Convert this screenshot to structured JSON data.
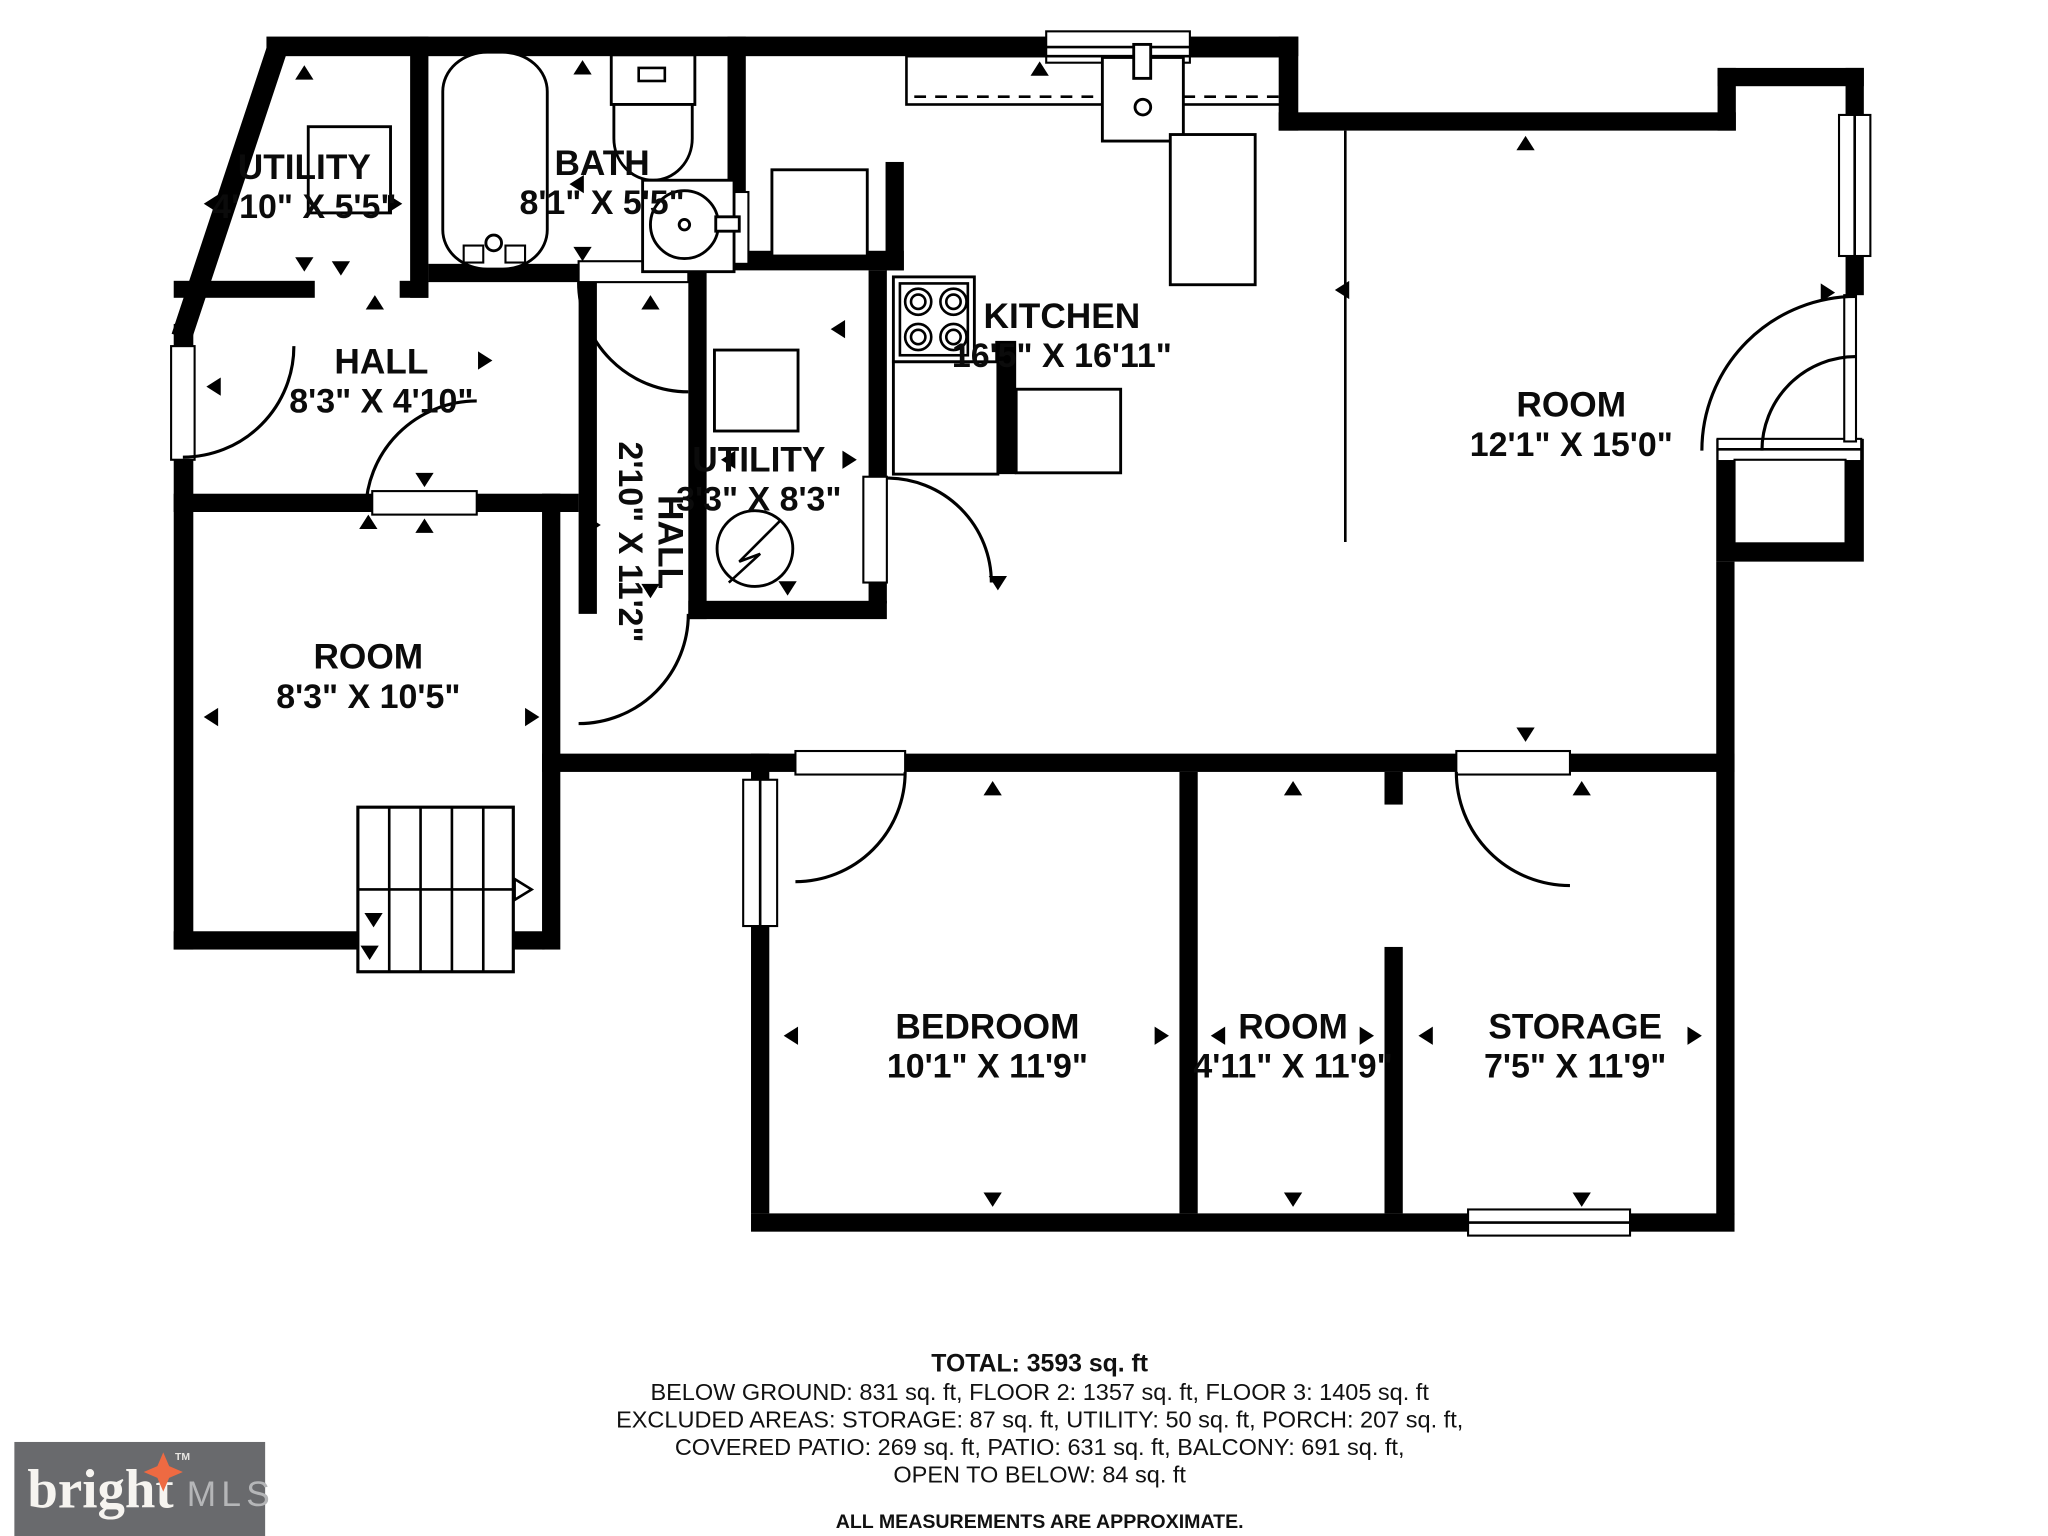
{
  "rooms": [
    {
      "id": "utility-top-left",
      "name": "UTILITY",
      "dims": "4'10\" X 5'5\""
    },
    {
      "id": "bath",
      "name": "BATH",
      "dims": "8'1\" X 5'5\""
    },
    {
      "id": "hall",
      "name": "HALL",
      "dims": "8'3\" X 4'10\""
    },
    {
      "id": "kitchen",
      "name": "KITCHEN",
      "dims": "16'5\" X 16'11\""
    },
    {
      "id": "room-right",
      "name": "ROOM",
      "dims": "12'1\" X 15'0\""
    },
    {
      "id": "utility-middle",
      "name": "UTILITY",
      "dims": "3'3\" X 8'3\""
    },
    {
      "id": "hall-corridor",
      "name": "HALL",
      "dims": "2'10\" X 11'2\""
    },
    {
      "id": "room-left",
      "name": "ROOM",
      "dims": "8'3\" X 10'5\""
    },
    {
      "id": "bedroom",
      "name": "BEDROOM",
      "dims": "10'1\" X 11'9\""
    },
    {
      "id": "room-small",
      "name": "ROOM",
      "dims": "4'11\" X 11'9\""
    },
    {
      "id": "storage",
      "name": "STORAGE",
      "dims": "7'5\" X 11'9\""
    }
  ],
  "footer": {
    "total": "TOTAL: 3593 sq. ft",
    "line2": "BELOW GROUND: 831 sq. ft, FLOOR 2: 1357 sq. ft, FLOOR 3: 1405 sq. ft",
    "line3": "EXCLUDED AREAS: STORAGE: 87 sq. ft, UTILITY: 50 sq. ft, PORCH: 207 sq. ft,",
    "line4": "COVERED PATIO: 269 sq. ft, PATIO: 631 sq. ft, BALCONY: 691 sq. ft,",
    "line5": "OPEN TO BELOW: 84 sq. ft",
    "disclaimer": "ALL MEASUREMENTS ARE APPROXIMATE."
  },
  "logo": {
    "brand": "bright",
    "tm": "TM",
    "suffix": "MLS",
    "box_color": "#696a6d",
    "star_color": "#ee6a42",
    "brand_color": "#f6f4f0",
    "suffix_color": "#b5b6b8"
  },
  "colors": {
    "walls": "#000000",
    "background": "#ffffff"
  }
}
